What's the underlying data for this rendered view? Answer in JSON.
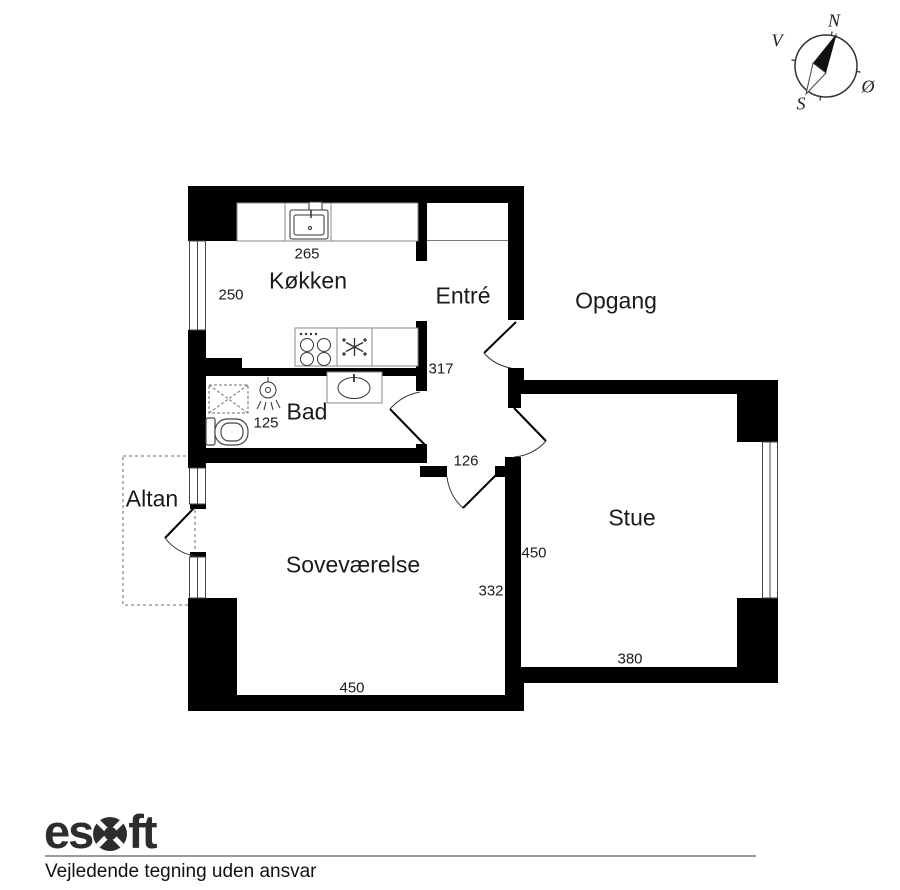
{
  "plan": {
    "rooms": {
      "kitchen": {
        "label": "Køkken"
      },
      "entry": {
        "label": "Entré"
      },
      "stairwell": {
        "label": "Opgang"
      },
      "bath": {
        "label": "Bad"
      },
      "balcony": {
        "label": "Altan"
      },
      "bedroom": {
        "label": "Soveværelse"
      },
      "living_room": {
        "label": "Stue"
      }
    },
    "measurements": {
      "kitchen_top": "265",
      "kitchen_left": "250",
      "entry_right": "317",
      "bath": "125",
      "hall": "126",
      "living_left": "450",
      "bedroom_right": "332",
      "living_bottom": "380",
      "bedroom_bottom": "450"
    }
  },
  "compass": {
    "n": "N",
    "s": "S",
    "v": "V",
    "oe": "Ø"
  },
  "footer": {
    "logo_prefix": "es",
    "logo_suffix": "ft",
    "disclaimer": "Vejledende tegning uden ansvar"
  },
  "colors": {
    "wall": "#000000",
    "text": "#1a1a1a",
    "logo": "#2e2d2c",
    "divider": "#9a9a9a"
  }
}
